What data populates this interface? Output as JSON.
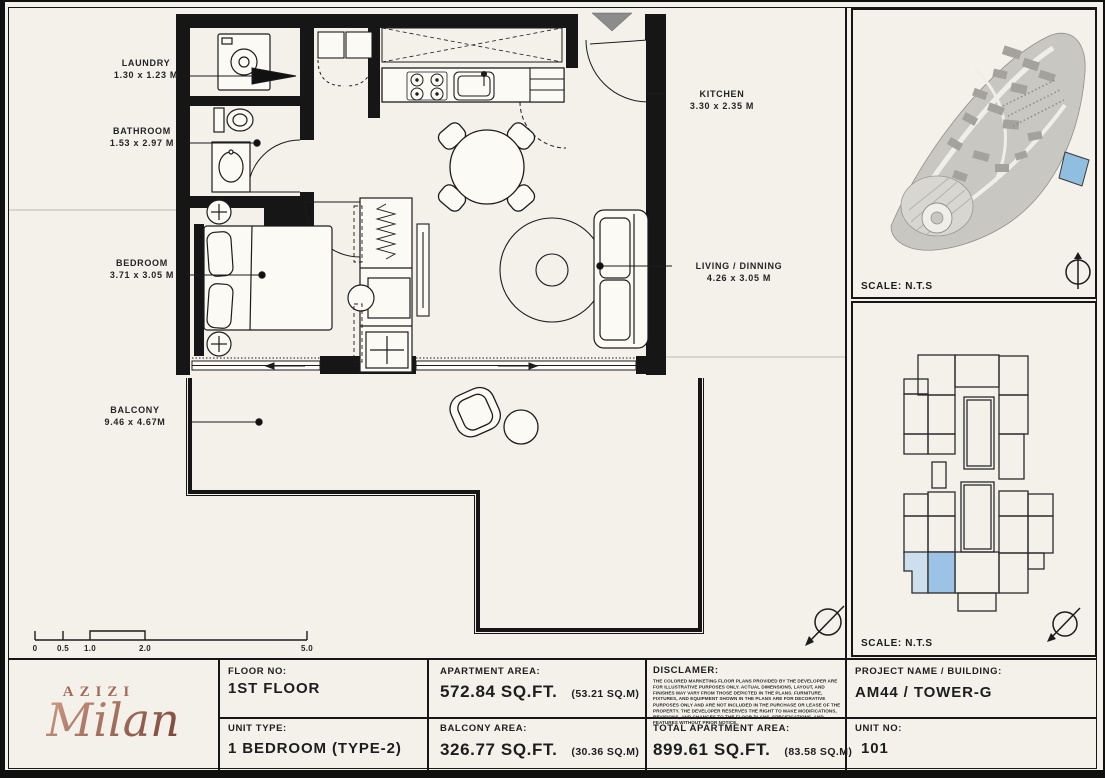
{
  "plan": {
    "rooms": {
      "laundry": {
        "name": "LAUNDRY",
        "dims": "1.30 x 1.23 M"
      },
      "bathroom": {
        "name": "BATHROOM",
        "dims": "1.53 x 2.97 M"
      },
      "bedroom": {
        "name": "BEDROOM",
        "dims": "3.71 x 3.05 M"
      },
      "kitchen": {
        "name": "KITCHEN",
        "dims": "3.30 x 2.35 M"
      },
      "living": {
        "name": "LIVING / DINNING",
        "dims": "4.26 x 3.05 M"
      },
      "balcony": {
        "name": "BALCONY",
        "dims": "9.46 x 4.67M"
      }
    },
    "scale_bar": {
      "labels": [
        "0",
        "0.5",
        "1.0",
        "2.0",
        "5.0"
      ]
    }
  },
  "panels": {
    "site_plan": {
      "scale": "SCALE: N.T.S"
    },
    "key_plan": {
      "scale": "SCALE: N.T.S"
    }
  },
  "logo": {
    "brand": "AZIZI",
    "name": "Milan"
  },
  "title_block": {
    "floor_no": {
      "label": "FLOOR NO:",
      "value": "1ST FLOOR"
    },
    "unit_type": {
      "label": "UNIT TYPE:",
      "value": "1 BEDROOM (TYPE-2)"
    },
    "apartment_area": {
      "label": "APARTMENT AREA:",
      "value": "572.84 SQ.FT.",
      "metric": "(53.21 SQ.M)"
    },
    "balcony_area": {
      "label": "BALCONY AREA:",
      "value": "326.77 SQ.FT.",
      "metric": "(30.36 SQ.M)"
    },
    "disclaimer": {
      "label": "DISCLAMER:",
      "text": "THE COLORED MARKETING FLOOR PLANS PROVIDED BY THE DEVELOPER ARE FOR ILLUSTRATIVE PURPOSES ONLY. ACTUAL DIMENSIONS, LAYOUT, AND FINISHES MAY VARY FROM THOSE DEPICTED IN THE PLANS. FURNITURE, FIXTURES, AND EQUIPMENT SHOWN IN THE PLANS ARE FOR DECORATIVE PURPOSES ONLY AND ARE NOT INCLUDED IN THE PURCHASE OR LEASE OF THE PROPERTY. THE DEVELOPER RESERVES THE RIGHT TO MAKE MODIFICATIONS, REVISIONS, AND CHANGES TO THE FLOOR PLANS, SPECIFICATIONS, AND FEATURES WITHOUT PRIOR NOTICE."
    },
    "total_area": {
      "label": "TOTAL APARTMENT AREA:",
      "value": "899.61 SQ.FT.",
      "metric": "(83.58 SQ.M)"
    },
    "project": {
      "label": "PROJECT NAME / BUILDING:",
      "value": "AM44 / TOWER-G"
    },
    "unit_no": {
      "label": "UNIT NO:",
      "value": "101"
    }
  },
  "colors": {
    "paper": "#f3f1ea",
    "highlight_blue": "#9cc3e3",
    "highlight_blue_light": "#cddeed",
    "logo_copper": "#a4695a"
  }
}
